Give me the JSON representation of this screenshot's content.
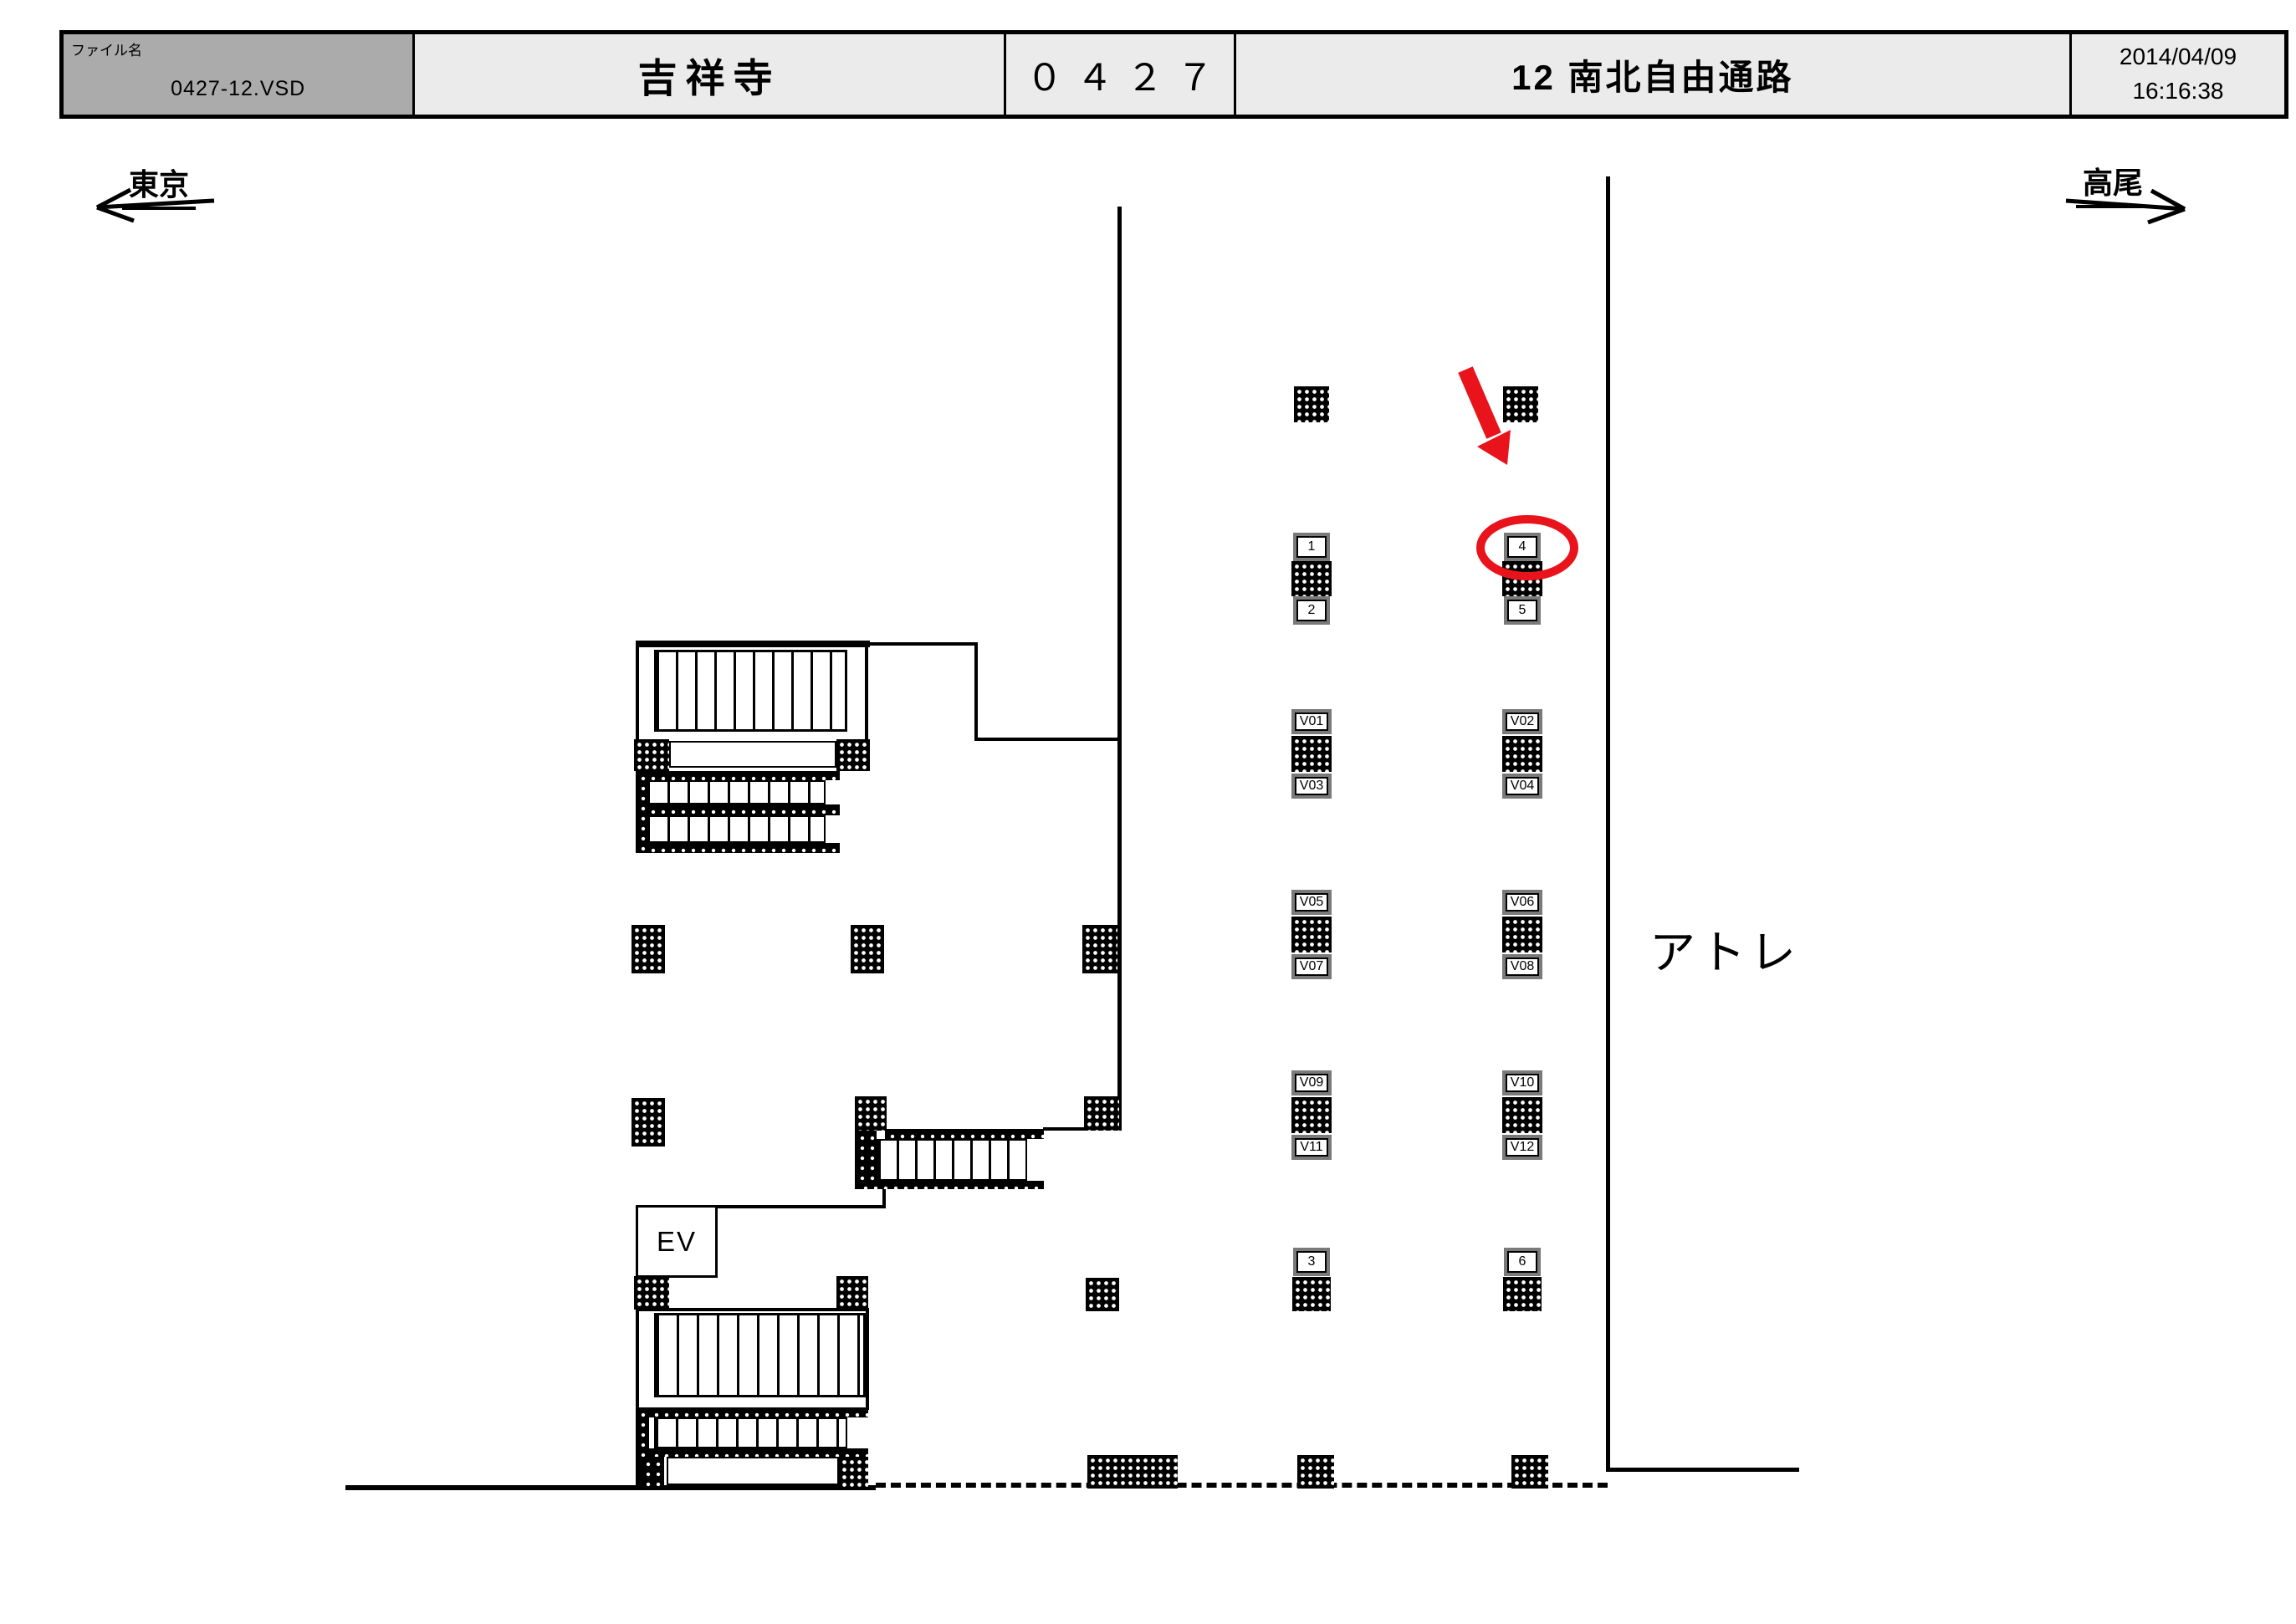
{
  "header": {
    "file_label": "ファイル名",
    "file_value": "0427-12.VSD",
    "station": "吉祥寺",
    "station_code": "０４２７",
    "drawing_title": "12 南北自由通路",
    "date": "2014/04/09",
    "time": "16:16:38"
  },
  "directions": {
    "left": "東京",
    "right": "高尾"
  },
  "map": {
    "area_label": "アトレ",
    "elevator_label": "EV",
    "signs": {
      "s1": "1",
      "s2": "2",
      "s3": "3",
      "s4": "4",
      "s5": "5",
      "s6": "6",
      "v01": "V01",
      "v02": "V02",
      "v03": "V03",
      "v04": "V04",
      "v05": "V05",
      "v06": "V06",
      "v07": "V07",
      "v08": "V08",
      "v09": "V09",
      "v10": "V10",
      "v11": "V11",
      "v12": "V12"
    },
    "highlight": {
      "circled_sign": "4",
      "annotation": "red arrow and circle"
    }
  },
  "colors": {
    "annotation_red": "#e8131b",
    "header_gray": "#ababab",
    "header_light": "#ebebeb",
    "line_black": "#000000"
  }
}
